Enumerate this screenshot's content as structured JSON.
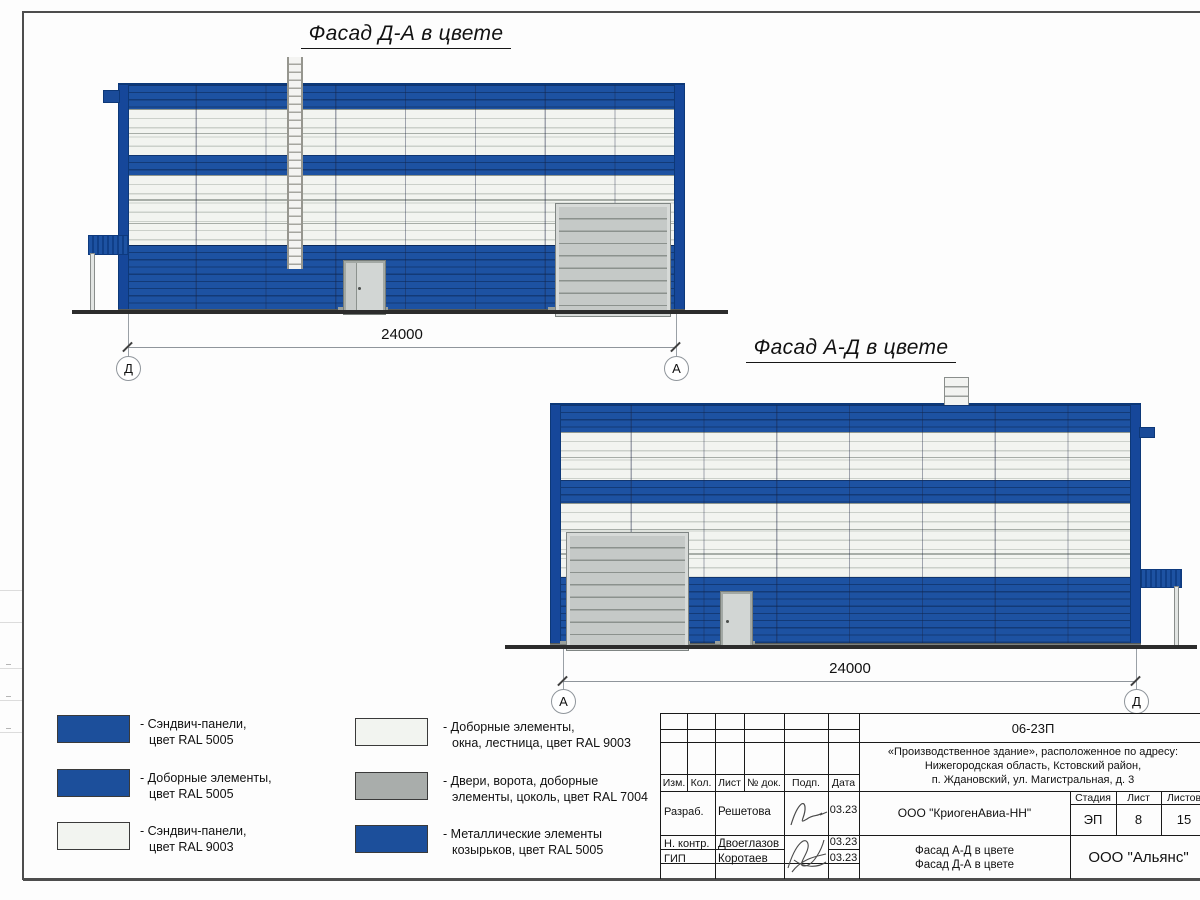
{
  "elevations": [
    {
      "title": "Фасад Д-А в цвете",
      "dimension": "24000",
      "axis_left": "Д",
      "axis_right": "А"
    },
    {
      "title": "Фасад А-Д в цвете",
      "dimension": "24000",
      "axis_left": "А",
      "axis_right": "Д"
    }
  ],
  "legend": {
    "items": [
      {
        "hex": "#1c4f9b",
        "line1": "- Сэндвич-панели,",
        "line2": "цвет RAL 5005"
      },
      {
        "hex": "#1c4f9b",
        "line1": "- Доборные элементы,",
        "line2": "цвет RAL 5005"
      },
      {
        "hex": "#f2f4f0",
        "line1": "- Сэндвич-панели,",
        "line2": "цвет RAL 9003"
      },
      {
        "hex": "#f2f4f0",
        "line1": "- Доборные элементы,",
        "line2": "окна, лестница, цвет RAL 9003"
      },
      {
        "hex": "#a9adab",
        "line1": "- Двери, ворота, доборные",
        "line2": "элементы, цоколь, цвет RAL 7004"
      },
      {
        "hex": "#1c4f9b",
        "line1": "- Металлические элементы",
        "line2": "козырьков, цвет RAL 5005"
      }
    ]
  },
  "title_block": {
    "doc_number": "06-23П",
    "address_line1": "«Производственное здание», расположенное по адресу:",
    "address_line2": "Нижегородская область, Кстовский район,",
    "address_line3": "п. Ждановский, ул. Магистральная, д. 3",
    "col_headers": [
      "Изм.",
      "Кол.",
      "Лист",
      "№ док.",
      "Подп.",
      "Дата"
    ],
    "rows": [
      {
        "role": "Разраб.",
        "name": "Решетова",
        "date": "03.23"
      },
      {
        "role": "Н. контр.",
        "name": "Двоеглазов",
        "date": "03.23"
      },
      {
        "role": "ГИП",
        "name": "Коротаев",
        "date": "03.23"
      }
    ],
    "org": "ООО \"КриогенАвиа-НН\"",
    "stage_label": "Стадия",
    "sheet_label": "Лист",
    "sheets_label": "Листов",
    "stage_value": "ЭП",
    "sheet_value": "8",
    "sheets_value": "15",
    "drawing_line1": "Фасад А-Д в цвете",
    "drawing_line2": "Фасад Д-А в цвете",
    "company": "ООО \"Альянс\""
  },
  "colors": {
    "ral5005_blue": "#1d52a2",
    "ral9003_white": "#f2f4f0",
    "ral7004_gray": "#a9adab"
  }
}
